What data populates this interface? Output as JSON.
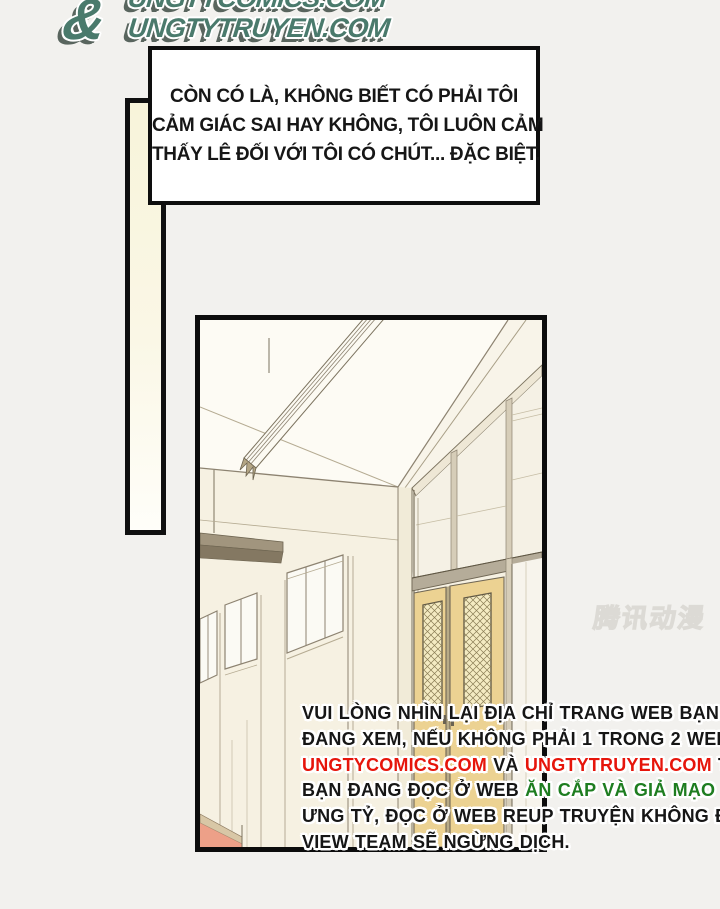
{
  "logo": {
    "line_top": "UNGTYCOMICS.COM",
    "line_bottom": "UNGTYTRUYEN.COM",
    "ampersand": "&",
    "color": "#4a7a6c"
  },
  "speech_bubble": {
    "lines": [
      "CÒN CÓ LÀ, KHÔNG BIẾT CÓ PHẢI TÔI",
      "CẢM GIÁC SAI HAY KHÔNG, TÔI LUÔN CẢM",
      "THẤY LÊ ĐỐI VỚI TÔI CÓ CHÚT... ĐẶC BIỆT."
    ]
  },
  "watermark": {
    "text": "腾讯动漫"
  },
  "notice": {
    "colors": {
      "black": "#161616",
      "red": "#e6150b",
      "green": "#1e7d20"
    },
    "lines": [
      {
        "segments": [
          {
            "text": "VUI LÒNG NHÌN LẠI ĐỊA CHỈ TRANG WEB BẠN",
            "color": "black"
          }
        ]
      },
      {
        "segments": [
          {
            "text": "ĐANG XEM, NẾU KHÔNG PHẢI 1 TRONG 2 WEB",
            "color": "black"
          }
        ]
      },
      {
        "segments": [
          {
            "text": "UNGTYCOMICS.COM",
            "color": "red"
          },
          {
            "text": " VÀ ",
            "color": "black"
          },
          {
            "text": "UNGTYTRUYEN.COM",
            "color": "red"
          },
          {
            "text": " THÌ",
            "color": "black"
          }
        ]
      },
      {
        "segments": [
          {
            "text": "BẠN ĐANG ĐỌC Ở WEB ",
            "color": "black"
          },
          {
            "text": "ĂN CẮP VÀ GIẢ MẠO",
            "color": "green"
          }
        ]
      },
      {
        "segments": [
          {
            "text": "ƯNG TỶ, ĐỌC Ở WEB REUP TRUYỆN KHÔNG ĐỦ",
            "color": "black"
          }
        ]
      },
      {
        "segments": [
          {
            "text": "VIEW TEAM SẼ NGỪNG DỊCH.",
            "color": "black"
          }
        ]
      }
    ]
  }
}
